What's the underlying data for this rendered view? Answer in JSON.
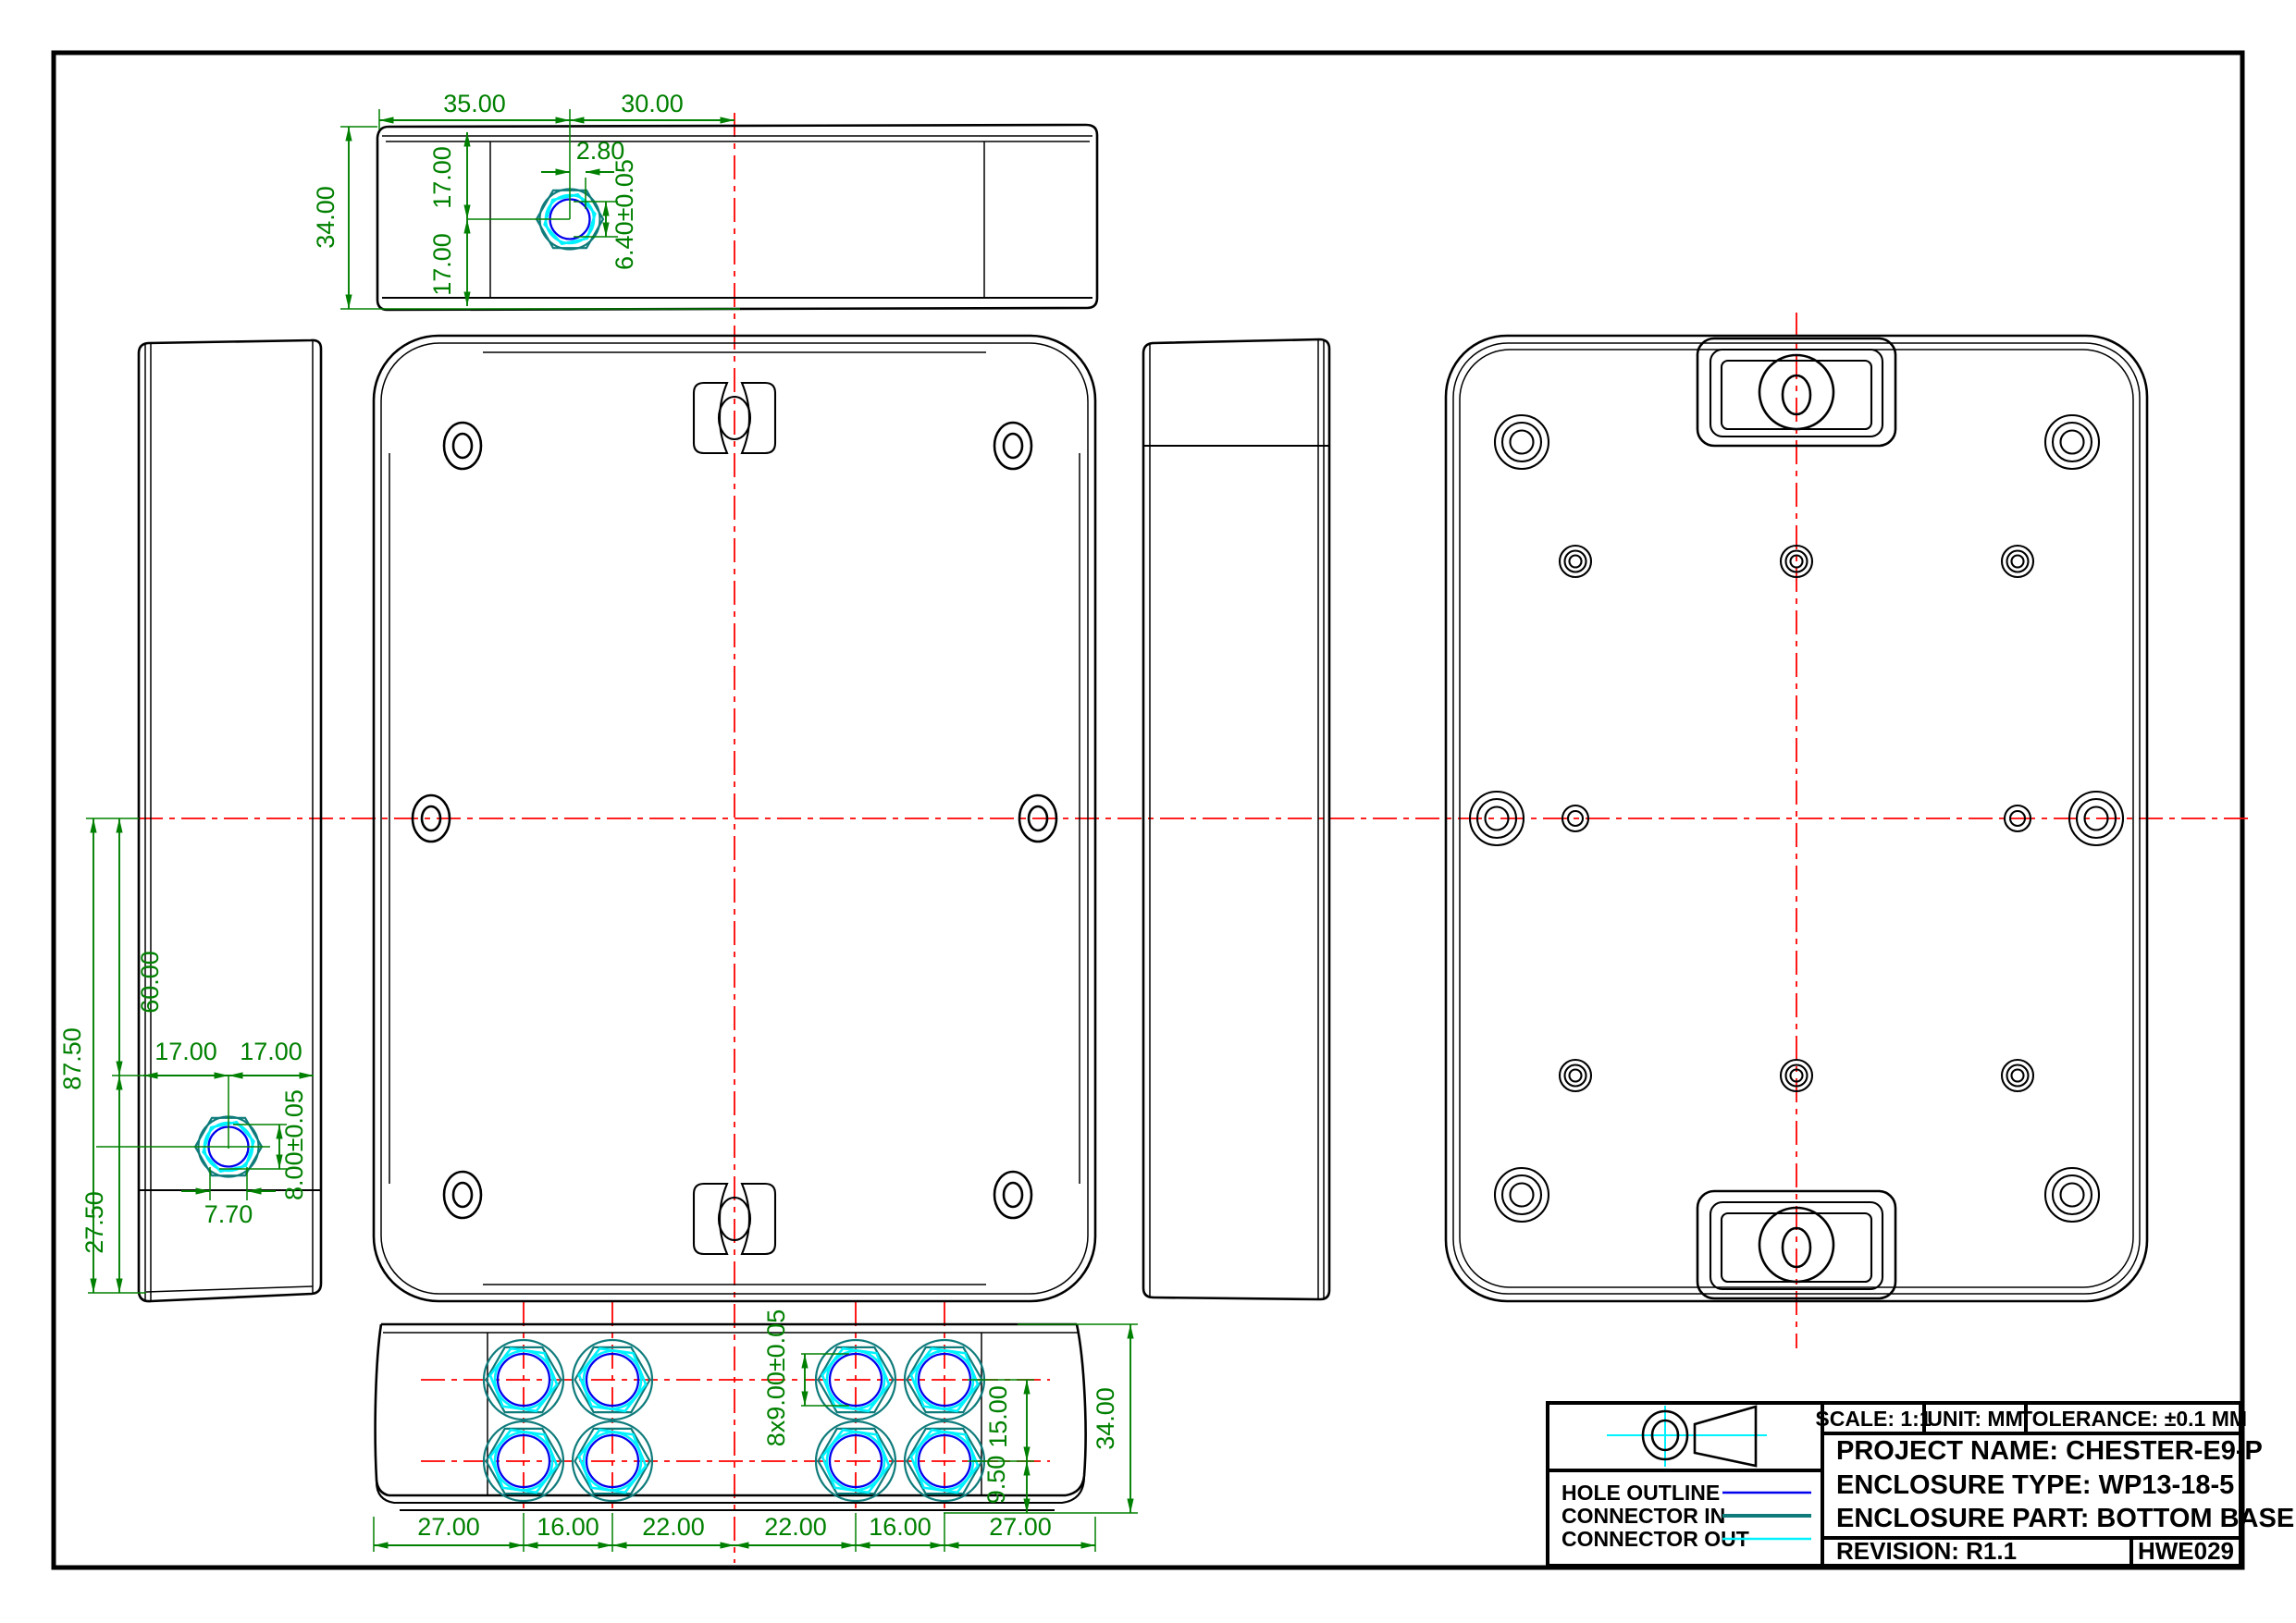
{
  "drawing": {
    "kind": "enclosure engineering drawing",
    "views": [
      "top",
      "left side",
      "front (inside of base)",
      "right side",
      "back (outside of base)",
      "bottom"
    ]
  },
  "colors": {
    "dimension": "#008000",
    "centerline": "#ff0000",
    "hole_outline": "#0000ee",
    "connector_in": "#0f7b7b",
    "connector_out": "#00f2ff",
    "outline": "#000000"
  },
  "dims": {
    "top": {
      "w_left": "35.00",
      "w_right": "30.00",
      "offset": "2.80",
      "h_upper": "17.00",
      "h_lower": "17.00",
      "height": "34.00",
      "hole": "6.40±0.05"
    },
    "left": {
      "total": "87.50",
      "upper": "60.00",
      "lower": "27.50",
      "w_left": "17.00",
      "w_right": "17.00",
      "hole": "8.00±0.05",
      "flat": "7.70"
    },
    "bottom": {
      "chain": [
        "27.00",
        "16.00",
        "22.00",
        "22.00",
        "16.00",
        "27.00"
      ],
      "holes": "8x9.00±0.05",
      "row_spacing": "15.00",
      "row_offset": "9.50",
      "height": "34.00"
    }
  },
  "legend": {
    "rows": [
      {
        "label": "HOLE OUTLINE",
        "color": "#0000ee"
      },
      {
        "label": "CONNECTOR IN",
        "color": "#0f7b7b"
      },
      {
        "label": "CONNECTOR OUT",
        "color": "#00f2ff"
      }
    ]
  },
  "title_block": {
    "scale": "SCALE: 1:1",
    "unit": "UNIT: MM",
    "tolerance": "TOLERANCE: ±0.1 MM",
    "project": "PROJECT NAME: CHESTER-E9-P",
    "enclosure_type": "ENCLOSURE TYPE: WP13-18-5",
    "enclosure_part": "ENCLOSURE PART: BOTTOM BASE",
    "revision": "REVISION: R1.1",
    "doc_code": "HWE029"
  }
}
